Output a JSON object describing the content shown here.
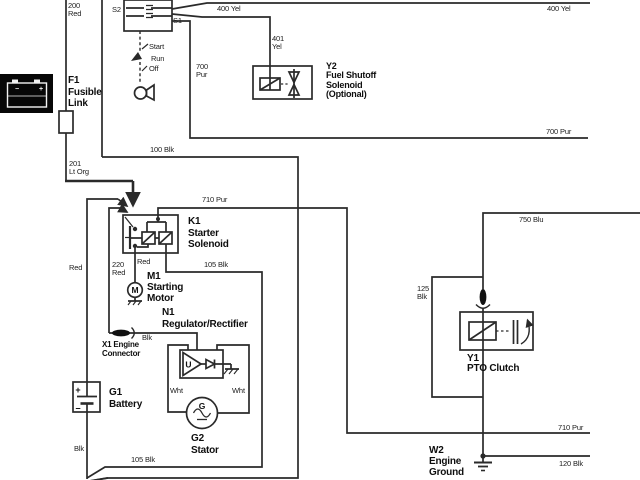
{
  "canvas": {
    "width": 640,
    "height": 480,
    "bg": "#ffffff",
    "line_color": "#2a2a2a"
  },
  "labels": {
    "w200": {
      "text": "200\nRed"
    },
    "s2": {
      "text": "S2"
    },
    "s1": {
      "text": "S1"
    },
    "start": {
      "text": "Start"
    },
    "run": {
      "text": "Run"
    },
    "off": {
      "text": "Off"
    },
    "yel400a": {
      "text": "400 Yel"
    },
    "yel400b": {
      "text": "400 Yel"
    },
    "yel401": {
      "text": "401\nYel"
    },
    "pur700a": {
      "text": "700\nPur"
    },
    "pur700b": {
      "text": "700 Pur"
    },
    "blk100": {
      "text": "100 Blk"
    },
    "org201": {
      "text": "201\nLt Org"
    },
    "pur710a": {
      "text": "710 Pur"
    },
    "red_batt": {
      "text": "Red"
    },
    "red220": {
      "text": "220\nRed"
    },
    "red_k1": {
      "text": "Red"
    },
    "blk105a": {
      "text": "105 Blk"
    },
    "blk_x1": {
      "text": "Blk"
    },
    "wht_l": {
      "text": "Wht"
    },
    "wht_r": {
      "text": "Wht"
    },
    "blk_batt": {
      "text": "Blk"
    },
    "blk105b": {
      "text": "105 Blk"
    },
    "blu750": {
      "text": "750 Blu"
    },
    "blk125": {
      "text": "125\nBlk"
    },
    "pur710b": {
      "text": "710 Pur"
    },
    "blk120": {
      "text": "120 Blk"
    }
  },
  "components": {
    "f1": {
      "text": "F1\nFusible\nLink"
    },
    "y2": {
      "text": "Y2\nFuel Shutoff\nSolenoid\n(Optional)"
    },
    "k1": {
      "text": "K1\nStarter\nSolenoid"
    },
    "m1": {
      "text": "M1\nStarting\nMotor"
    },
    "n1": {
      "text": "N1\nRegulator/Rectifier"
    },
    "x1": {
      "text": "X1 Engine\nConnector"
    },
    "g1": {
      "text": "G1\nBattery"
    },
    "g2": {
      "text": "G2\nStator"
    },
    "y1": {
      "text": "Y1\nPTO Clutch"
    },
    "w2": {
      "text": "W2\nEngine\nGround"
    }
  },
  "symbols": {
    "motor_letter": "M",
    "stator_letter": "G",
    "regulator_letter": "U",
    "battery_plus": "+",
    "battery_minus": "−",
    "photo_plus": "+",
    "photo_minus": "−"
  }
}
